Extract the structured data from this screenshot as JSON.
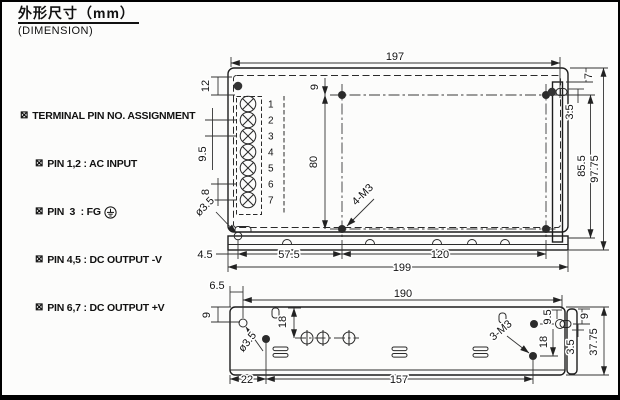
{
  "title": {
    "heading": "外形尺寸（mm）",
    "subheading": "(DIMENSION)"
  },
  "notes": {
    "bullet": "⊠",
    "heading": "TERMINAL PIN NO. ASSIGNMENT",
    "rows": [
      "PIN 1,2 : AC INPUT",
      "PIN  3  : FG",
      "PIN 4,5 : DC OUTPUT -V",
      "PIN 6,7 : DC OUTPUT +V"
    ]
  },
  "terminal": {
    "pin_numbers": [
      "1",
      "2",
      "3",
      "4",
      "5",
      "6",
      "7"
    ]
  },
  "top_view": {
    "dim_top_width": "197",
    "dim_terminal_offset": "12",
    "dim_terminal_pitch": "9.5",
    "dim_terminal_pitch2": "8",
    "dim_hole_top_offset": "9",
    "dim_hole_span_v": "80",
    "mounting_holes_label": "4-M3",
    "hole_dia_label": "ø3.5",
    "dim_bottom_4_5": "4.5",
    "dim_bottom_57_5": "57.5",
    "dim_bottom_120": "120",
    "dim_bottom_width": "199",
    "dim_right_7": "7",
    "dim_right_3_5": "3.5",
    "dim_right_85_5": "85.5",
    "dim_right_97_75": "97.75"
  },
  "bottom_view": {
    "dim_top_6_5": "6.5",
    "dim_top_width": "190",
    "dim_left_9": "9",
    "dim_left_18": "18",
    "hole_dia_label": "ø3.5",
    "dim_bottom_22": "22",
    "dim_bottom_157": "157",
    "dim_right_9_5": "9.5",
    "dim_right_18": "18",
    "mounting_holes_label": "3-M3",
    "dim_right_9": "9",
    "dim_right_3_5": "3.5",
    "dim_right_37_75": "37.75"
  }
}
